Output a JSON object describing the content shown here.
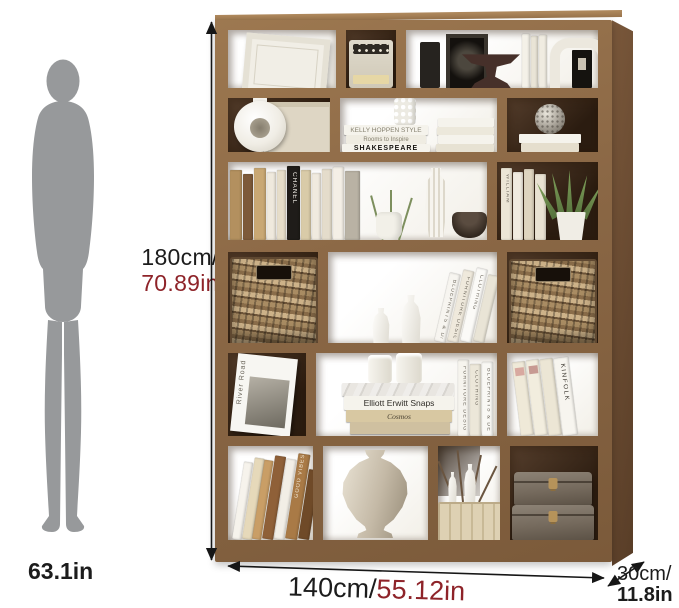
{
  "dimensions": {
    "height_cm": "180cm/",
    "height_in": "70.89in",
    "width_cm": "140cm/",
    "width_in": "55.12in",
    "depth_cm": "30cm/",
    "depth_in": "11.8in",
    "person_height": "63.1in"
  },
  "colors": {
    "background": "#ffffff",
    "wood_front": "#8e6b48",
    "wood_side": "#6a4c33",
    "accent_red": "#8e2329",
    "text": "#1c1c1c",
    "person_silhouette": "#97999b",
    "basket_wicker": "#a08059"
  },
  "icons": {
    "height_arrow": "vertical-double-arrow",
    "width_arrow": "horizontal-double-arrow",
    "depth_arrow": "diagonal-double-arrow"
  },
  "books": {
    "kelly_hoppen": "KELLY HOPPEN STYLE",
    "rooms_to_inspire": "Rooms to Inspire",
    "shakespeare": "SHAKESPEARE",
    "chanel": "CHANEL",
    "william": "WILLIAM",
    "elliott_erwitt": "Elliott Erwitt Snaps",
    "cosmos": "Cosmos",
    "kinfolk": "KINFOLK",
    "furniture_design": "FURNITURE DESIGN",
    "clothing": "CLOTHING",
    "blueprints": "BLUEPRINTS & DESIGNS",
    "river_road": "River Road",
    "good_vibes": "GOOD VIBES"
  }
}
